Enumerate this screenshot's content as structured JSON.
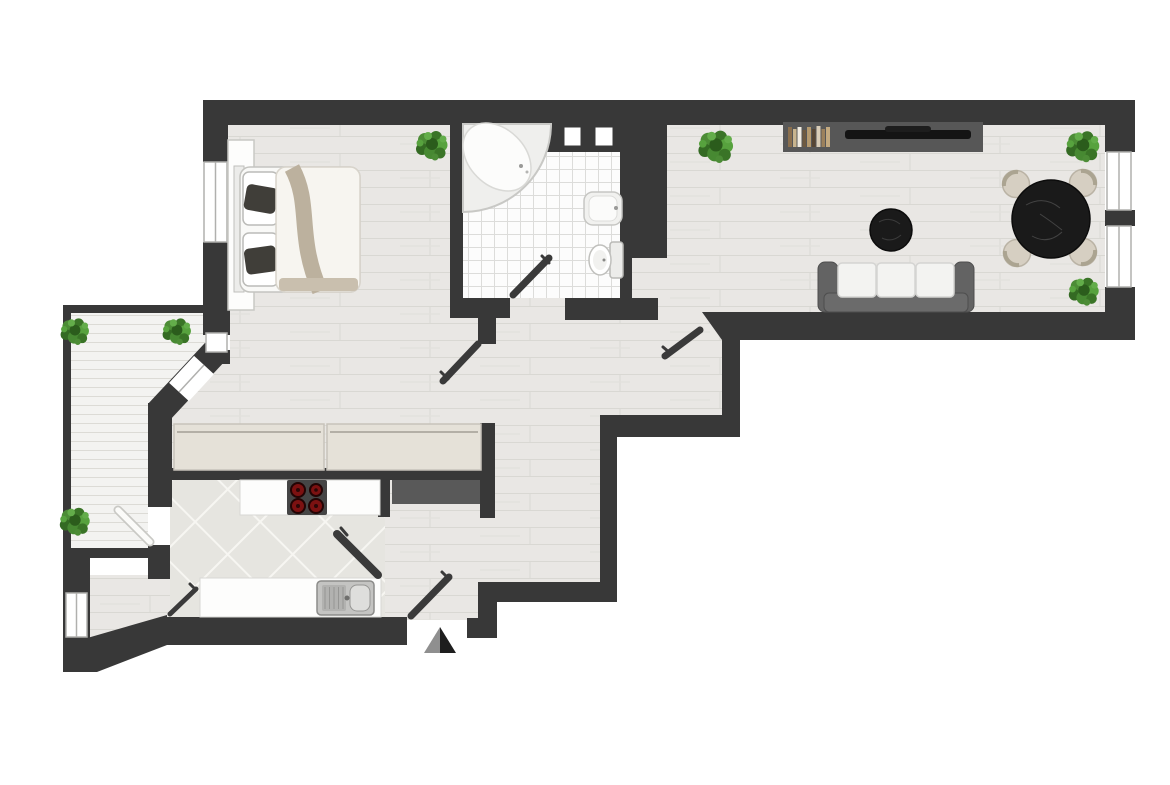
{
  "meta": {
    "title": "Apartment floor plan, top-down view",
    "view": "top-down",
    "width_px": 1170,
    "height_px": 785
  },
  "palette": {
    "wall": "#383838",
    "plank_floor": "#e9e8e5",
    "plank_line": "#d9d8d3",
    "bath_tile": "#fcfcfc",
    "bath_grid": "#dcdcda",
    "kitchen_tile": "#e8e7e2",
    "kitchen_grout": "#f7f6f2",
    "deck": "#f3f3f1",
    "marble_black": "#1a1a1a",
    "chair_beige": "#d6cfc2",
    "sofa_frame": "#636363",
    "cushion_white": "#f3f3f1",
    "blanket_beige": "#bcb19e",
    "plant_green": "#4c8c36",
    "burner_red": "#7c1111",
    "counter_white": "#fdfdfc",
    "sideboard_beige": "#e5e1d8",
    "console_gray": "#575757"
  },
  "rooms": [
    {
      "id": "bedroom",
      "label": "Bedroom"
    },
    {
      "id": "bathroom",
      "label": "Bathroom"
    },
    {
      "id": "living-room",
      "label": "Living room"
    },
    {
      "id": "kitchen",
      "label": "Kitchen"
    },
    {
      "id": "hallway",
      "label": "Hallway"
    },
    {
      "id": "entry",
      "label": "Entry corridor"
    },
    {
      "id": "balcony",
      "label": "Balcony terrace"
    }
  ],
  "furniture": {
    "bed": "Double bed with two pillows and beige blanket",
    "wardrobe": "Wardrobe along bedroom wall",
    "bathtub": "Corner bathtub",
    "bathroom_sink": "Washbasin",
    "toilet": "Toilet",
    "media_console": "Media console",
    "books": "Row of books",
    "tv": "Flat-screen TV",
    "coffee_table": "Round black marble coffee table",
    "sofa": "Three-seat sofa",
    "dining_table": "Round black marble dining table",
    "dining_chair": "Dining chair",
    "sideboard": "Hallway sideboard",
    "cooktop_counter": "Kitchen counter with cooktop",
    "cooktop": "Four-burner cooktop",
    "appliance": "Kitchen appliance block",
    "sink_counter": "Kitchen counter with sink",
    "kitchen_sink": "Stainless double sink with drainboard",
    "plant": "Potted green plant"
  },
  "openings": {
    "door_leaf": "Open door leaf",
    "balcony_door": "Balcony door leaf",
    "window": "Window",
    "shaft": "Ventilation shaft",
    "entrance_arrow": "Entrance direction arrow"
  },
  "counts": {
    "plants": 7,
    "door_leaves": 7,
    "windows": 5,
    "dining_chairs": 4,
    "shafts": 2
  }
}
